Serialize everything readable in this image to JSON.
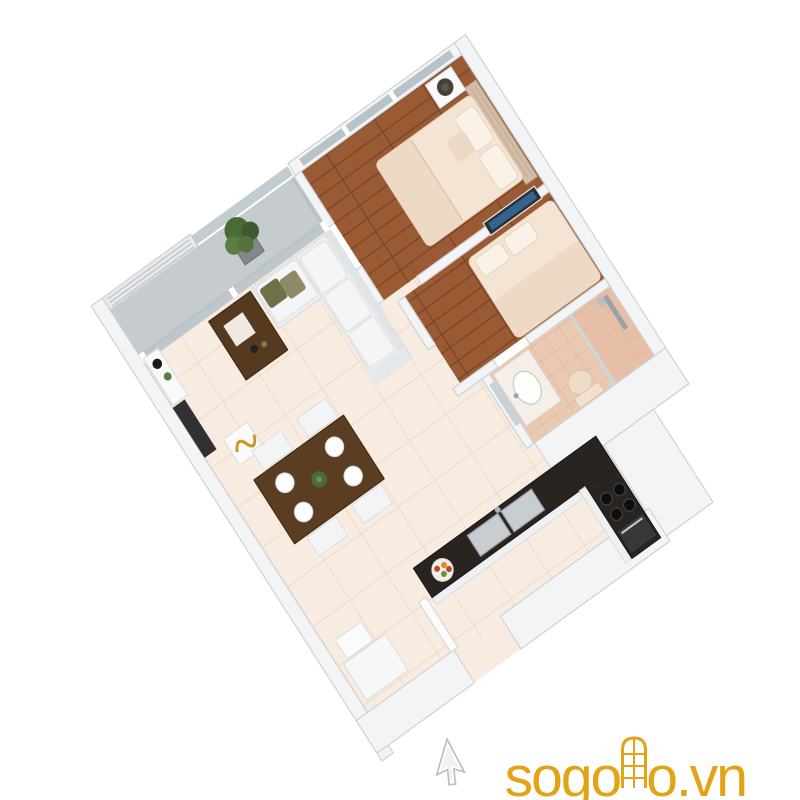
{
  "watermark": {
    "prefix": "sogo",
    "suffix": "o.vn",
    "full_text": "sogoho.vn",
    "color": "#E2A414",
    "door_icon": "arched-door-with-panes"
  },
  "cursor": {
    "icon": "arrow-cursor",
    "color": "#ffffff"
  },
  "scene": {
    "type": "3d-isometric-floor-plan",
    "subject": "two-bedroom-apartment",
    "projection": "isometric",
    "palette": {
      "background": "#ffffff",
      "wall": "#f3f4f6",
      "wall_edge": "#cdd2d6",
      "tile_floor": "#f7ecdf",
      "tile_line": "#e8d8c7",
      "wood_floor": "#9a5a33",
      "wood_line": "#7c4526",
      "bath_tile": "#eac9b2",
      "bath_line": "#d9ae94",
      "balcony_floor": "#c6cbd0",
      "glass": "#b4bfc6",
      "sofa": "#eceef0",
      "cushion": "#f4f5f6",
      "dark_wood": "#553a20",
      "dining_wood": "#5a3d22",
      "counter_top": "#29241f",
      "cabinet": "#eff0f1",
      "bedding": "#f4e4d4",
      "blanket": "#eed9c4",
      "pillow": "#faf2e7",
      "headboard": "#d3bda6",
      "plant_green": "#4a6a36",
      "steel": "#c7cdd1",
      "olive_pillow": "#6e7148",
      "gold_decor": "#c9972b",
      "art_blue": "#35628f",
      "watermark_gold": "#E2A414"
    },
    "rooms": [
      {
        "name": "bedroom-1",
        "position": "top",
        "floor": "dark-wood",
        "items": [
          "double-bed",
          "tufted-headboard",
          "pillows",
          "nightstand",
          "table-lamp",
          "window-wall"
        ]
      },
      {
        "name": "bedroom-2",
        "position": "middle-right",
        "floor": "dark-wood",
        "items": [
          "double-bed",
          "pillows",
          "wall-picture"
        ]
      },
      {
        "name": "bathroom",
        "position": "right",
        "floor": "terracotta-tile",
        "items": [
          "vanity-sink",
          "mirror",
          "shower",
          "glass-divider",
          "toilet"
        ]
      },
      {
        "name": "living-room",
        "position": "center-left",
        "floor": "cream-tile",
        "items": [
          "l-shaped-sofa",
          "throw-pillows",
          "coffee-table",
          "tv-console",
          "decor-vase",
          "gold-ornament",
          "display-stand"
        ]
      },
      {
        "name": "dining-area",
        "position": "bottom-left",
        "floor": "cream-tile",
        "items": [
          "dining-table",
          "chairs-x4",
          "place-settings-x4",
          "centerpiece-plant"
        ]
      },
      {
        "name": "kitchen",
        "position": "bottom-center",
        "floor": "cream-tile",
        "items": [
          "l-shaped-counter",
          "black-countertop",
          "double-sink",
          "faucet",
          "cooktop",
          "oven",
          "fruit-plate"
        ]
      },
      {
        "name": "balcony",
        "position": "top-left",
        "floor": "grey-concrete",
        "items": [
          "louvered-railing",
          "glass-railing",
          "sliding-glass-door",
          "potted-plant"
        ]
      },
      {
        "name": "entrance",
        "position": "bottom",
        "floor": "cream-tile",
        "items": [
          "open-door",
          "shoe-cabinet"
        ]
      }
    ]
  }
}
